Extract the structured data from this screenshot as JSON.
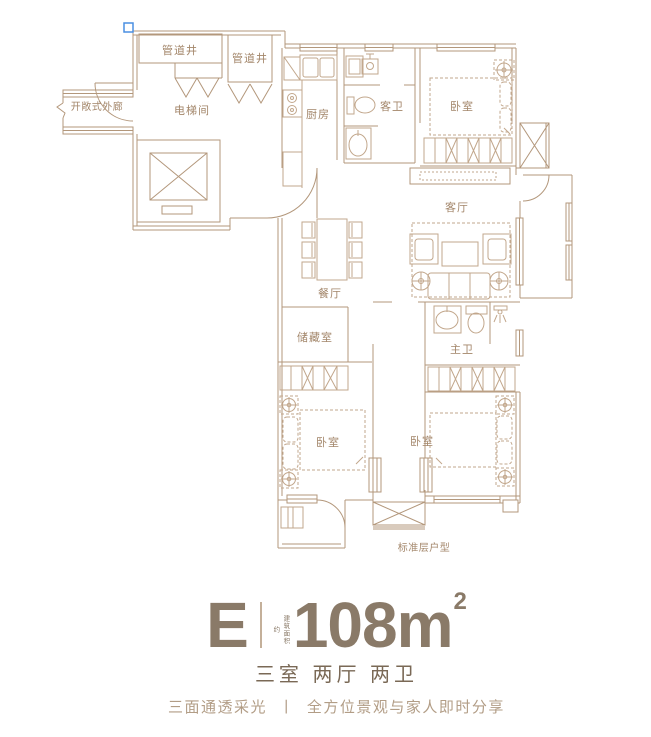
{
  "plan": {
    "labels": {
      "pipe_shaft_1": "管道井",
      "pipe_shaft_2": "管道井",
      "open_corridor": "开敞式外廊",
      "elevator_hall": "电梯间",
      "kitchen": "厨房",
      "guest_bath": "客卫",
      "bedroom_top_right": "卧室",
      "living_room": "客厅",
      "dining_room": "餐厅",
      "storage": "储藏室",
      "master_bath": "主卫",
      "bedroom_bottom_left": "卧室",
      "bedroom_bottom_middle": "卧室",
      "caption": "标准层户型"
    },
    "colors": {
      "wall_line": "#b3977b",
      "furniture_line": "#c2a78c",
      "label_text": "#a3866a",
      "selection_handle": "#4a8fe2"
    }
  },
  "title_block": {
    "unit": "E",
    "area_prefix": "建筑面积约",
    "area_value": "108",
    "area_unit": "m",
    "area_sup": "2",
    "rooms": "三室 两厅 两卫",
    "tagline_left": "三面通透采光",
    "tagline_divider": "丨",
    "tagline_right": "全方位景观与家人即时分享",
    "colors": {
      "primary_text": "#8a7a68",
      "rooms_text": "#7a6956",
      "tagline_text": "#b29d86",
      "divider": "#c4b09a"
    }
  }
}
